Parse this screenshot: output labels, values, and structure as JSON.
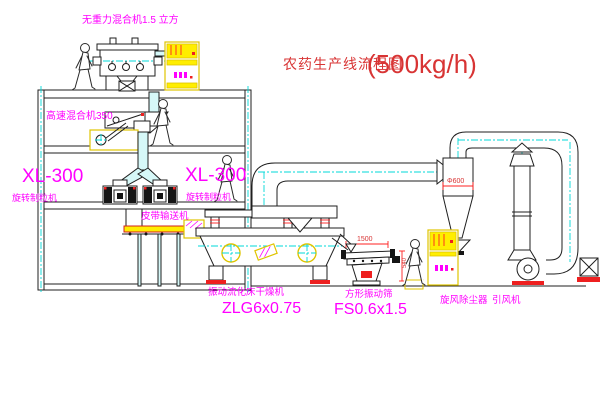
{
  "title": {
    "text": "农药生产线流程图",
    "capacity": "(500kg/h)"
  },
  "labels": {
    "top_mixer": "无重力混合机1.5 立方",
    "mixer_350": "高速混合机350",
    "granulator_left_model": "XL-300",
    "granulator_left_name": "旋转制粒机",
    "granulator_right_model": "XL-300",
    "granulator_right_name": "旋转制粒机",
    "belt_conveyor": "皮带输送机",
    "dryer_name": "振动流化床干燥机",
    "dryer_model": "ZLG6x0.75",
    "sieve_name": "方形振动筛",
    "sieve_model": "FS0.6x1.5",
    "cyclone": "旋风除尘器",
    "fan": "引风机"
  },
  "dimensions": {
    "sieve_length": "1500",
    "sieve_height": "540",
    "cyclone_diameter": "Φ600"
  },
  "colors": {
    "label_magenta": "#ff00ff",
    "title_red": "#d83434",
    "dimension_red": "#ff2020",
    "centerline_cyan": "#00d8d8",
    "highlight_yellow": "#ffee00"
  }
}
